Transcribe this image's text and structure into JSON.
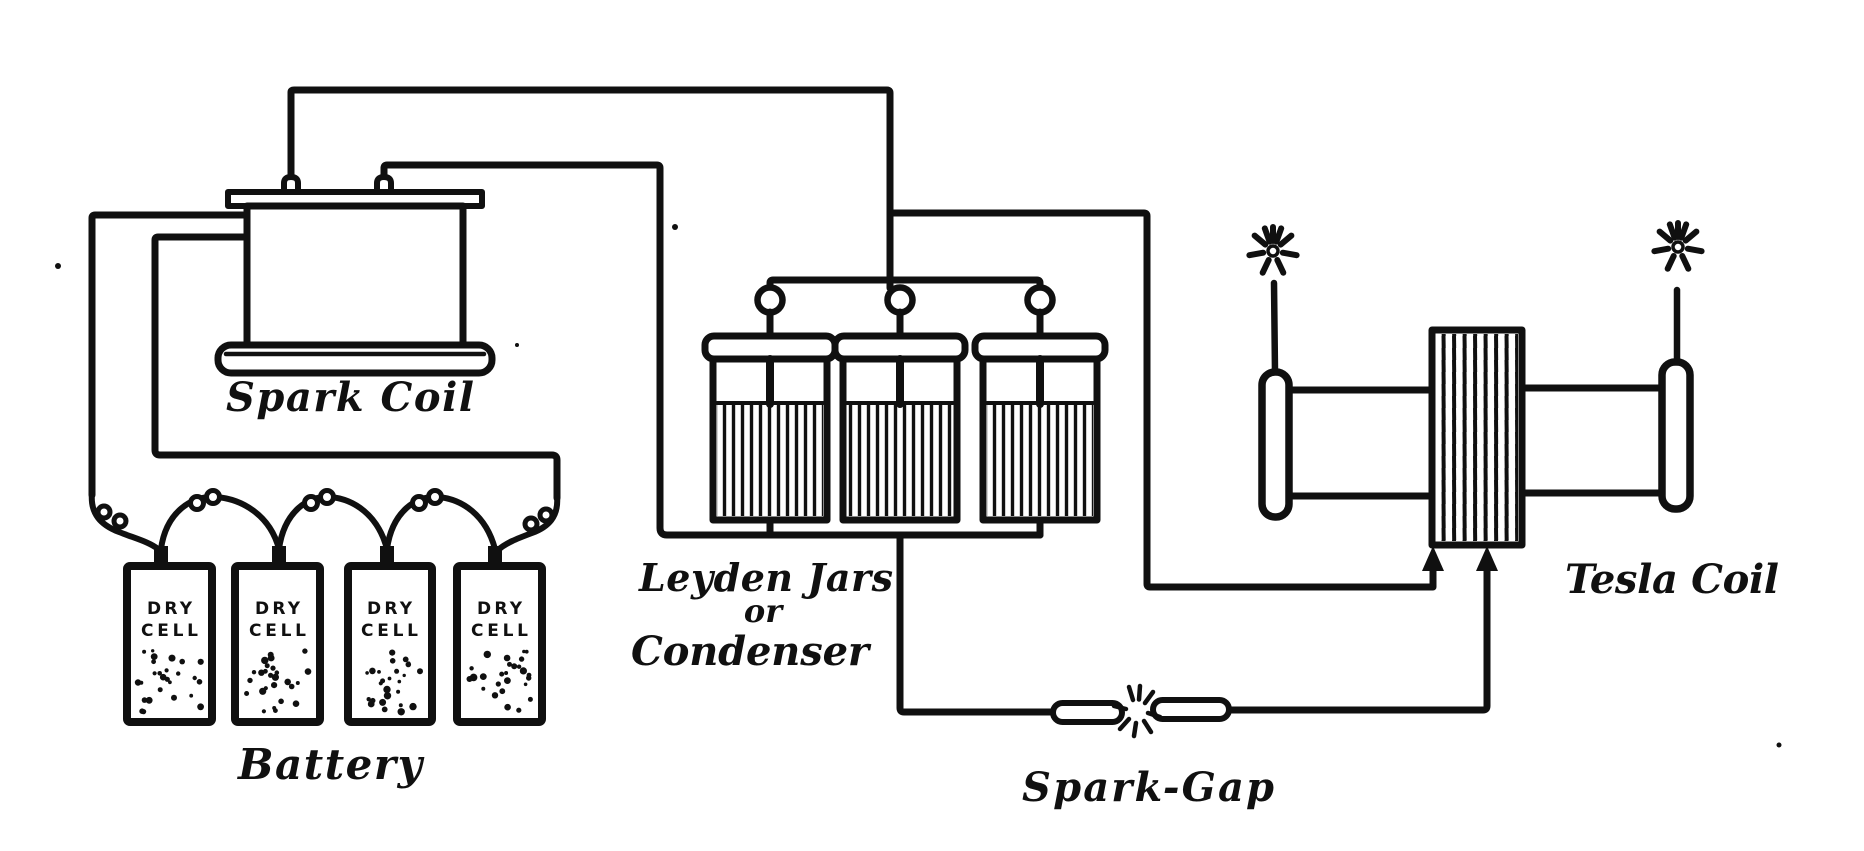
{
  "canvas": {
    "width": 1864,
    "height": 851,
    "ink_color": "#101010",
    "paper_color": "#ffffff"
  },
  "labels": {
    "spark_coil": "Spark Coil",
    "battery": "Battery",
    "leyden_line1": "Leyden Jars",
    "leyden_line2": "or",
    "leyden_line3": "Condenser",
    "spark_gap": "Spark-Gap",
    "tesla_coil": "Tesla Coil",
    "dry_cell_line1": "DRY",
    "dry_cell_line2": "CELL"
  }
}
